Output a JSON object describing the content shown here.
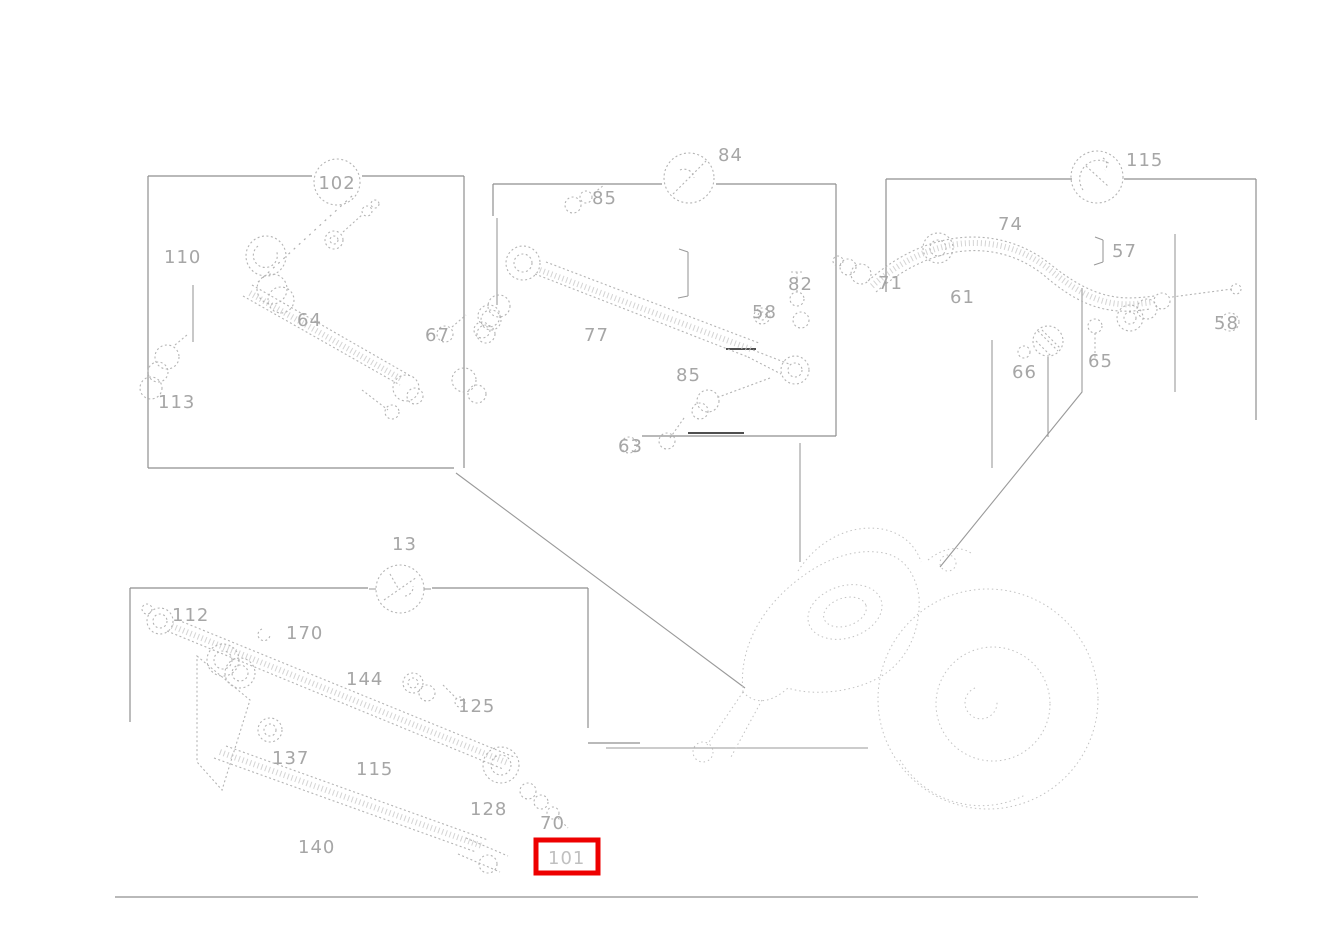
{
  "diagram": {
    "background_color": "#ffffff",
    "line_color": "#b4b4b4",
    "label_color": "#a6a6a6",
    "highlight": {
      "part_number": "101",
      "color": "#ee0000",
      "x": 536,
      "y": 840,
      "width": 62,
      "height": 33
    },
    "panels": [
      {
        "name": "top-left-panel"
      },
      {
        "name": "top-middle-panel"
      },
      {
        "name": "top-right-panel"
      },
      {
        "name": "bottom-left-panel"
      },
      {
        "name": "axle-illustration"
      }
    ],
    "circled_refs": [
      {
        "text": "102",
        "x": 337,
        "y": 182,
        "r": 23
      },
      {
        "text": "",
        "x": 689,
        "y": 178,
        "r": 25
      },
      {
        "text": "",
        "x": 1097,
        "y": 177,
        "r": 26
      },
      {
        "text": "",
        "x": 400,
        "y": 589,
        "r": 24
      }
    ],
    "labels": [
      {
        "text": "102",
        "x": 337,
        "y": 189,
        "anchor": "middle",
        "panel": "top-left"
      },
      {
        "text": "110",
        "x": 164,
        "y": 263,
        "panel": "top-left"
      },
      {
        "text": "64",
        "x": 297,
        "y": 326,
        "panel": "top-left"
      },
      {
        "text": "67",
        "x": 425,
        "y": 341,
        "panel": "top-left"
      },
      {
        "text": "113",
        "x": 158,
        "y": 408,
        "panel": "top-left"
      },
      {
        "text": "84",
        "x": 718,
        "y": 161,
        "panel": "top-middle"
      },
      {
        "text": "85",
        "x": 592,
        "y": 204,
        "panel": "top-middle"
      },
      {
        "text": "77",
        "x": 584,
        "y": 341,
        "panel": "top-middle"
      },
      {
        "text": "82",
        "x": 788,
        "y": 290,
        "panel": "top-middle"
      },
      {
        "text": "58",
        "x": 752,
        "y": 318,
        "panel": "top-middle"
      },
      {
        "text": "85",
        "x": 676,
        "y": 381,
        "panel": "top-middle"
      },
      {
        "text": "63",
        "x": 618,
        "y": 452,
        "panel": "top-middle"
      },
      {
        "text": "115",
        "x": 1126,
        "y": 166,
        "panel": "top-right"
      },
      {
        "text": "74",
        "x": 998,
        "y": 230,
        "panel": "top-right"
      },
      {
        "text": "57",
        "x": 1112,
        "y": 257,
        "panel": "top-right"
      },
      {
        "text": "71",
        "x": 878,
        "y": 289,
        "panel": "top-right"
      },
      {
        "text": "61",
        "x": 950,
        "y": 303,
        "panel": "top-right"
      },
      {
        "text": "58",
        "x": 1214,
        "y": 329,
        "panel": "top-right"
      },
      {
        "text": "66",
        "x": 1012,
        "y": 378,
        "panel": "top-right"
      },
      {
        "text": "65",
        "x": 1088,
        "y": 367,
        "panel": "top-right"
      },
      {
        "text": "13",
        "x": 392,
        "y": 550,
        "panel": "bottom-left"
      },
      {
        "text": "112",
        "x": 172,
        "y": 621,
        "panel": "bottom-left"
      },
      {
        "text": "170",
        "x": 286,
        "y": 639,
        "panel": "bottom-left"
      },
      {
        "text": "144",
        "x": 346,
        "y": 685,
        "panel": "bottom-left"
      },
      {
        "text": "125",
        "x": 458,
        "y": 712,
        "panel": "bottom-left"
      },
      {
        "text": "137",
        "x": 272,
        "y": 764,
        "panel": "bottom-left"
      },
      {
        "text": "115",
        "x": 356,
        "y": 775,
        "panel": "bottom-left"
      },
      {
        "text": "128",
        "x": 470,
        "y": 815,
        "panel": "bottom-left"
      },
      {
        "text": "140",
        "x": 298,
        "y": 853,
        "panel": "bottom-left"
      },
      {
        "text": "70",
        "x": 540,
        "y": 829,
        "panel": "bottom-left"
      },
      {
        "text": "101",
        "x": 548,
        "y": 864,
        "panel": "bottom-left",
        "faint": true,
        "highlighted": true
      }
    ]
  }
}
